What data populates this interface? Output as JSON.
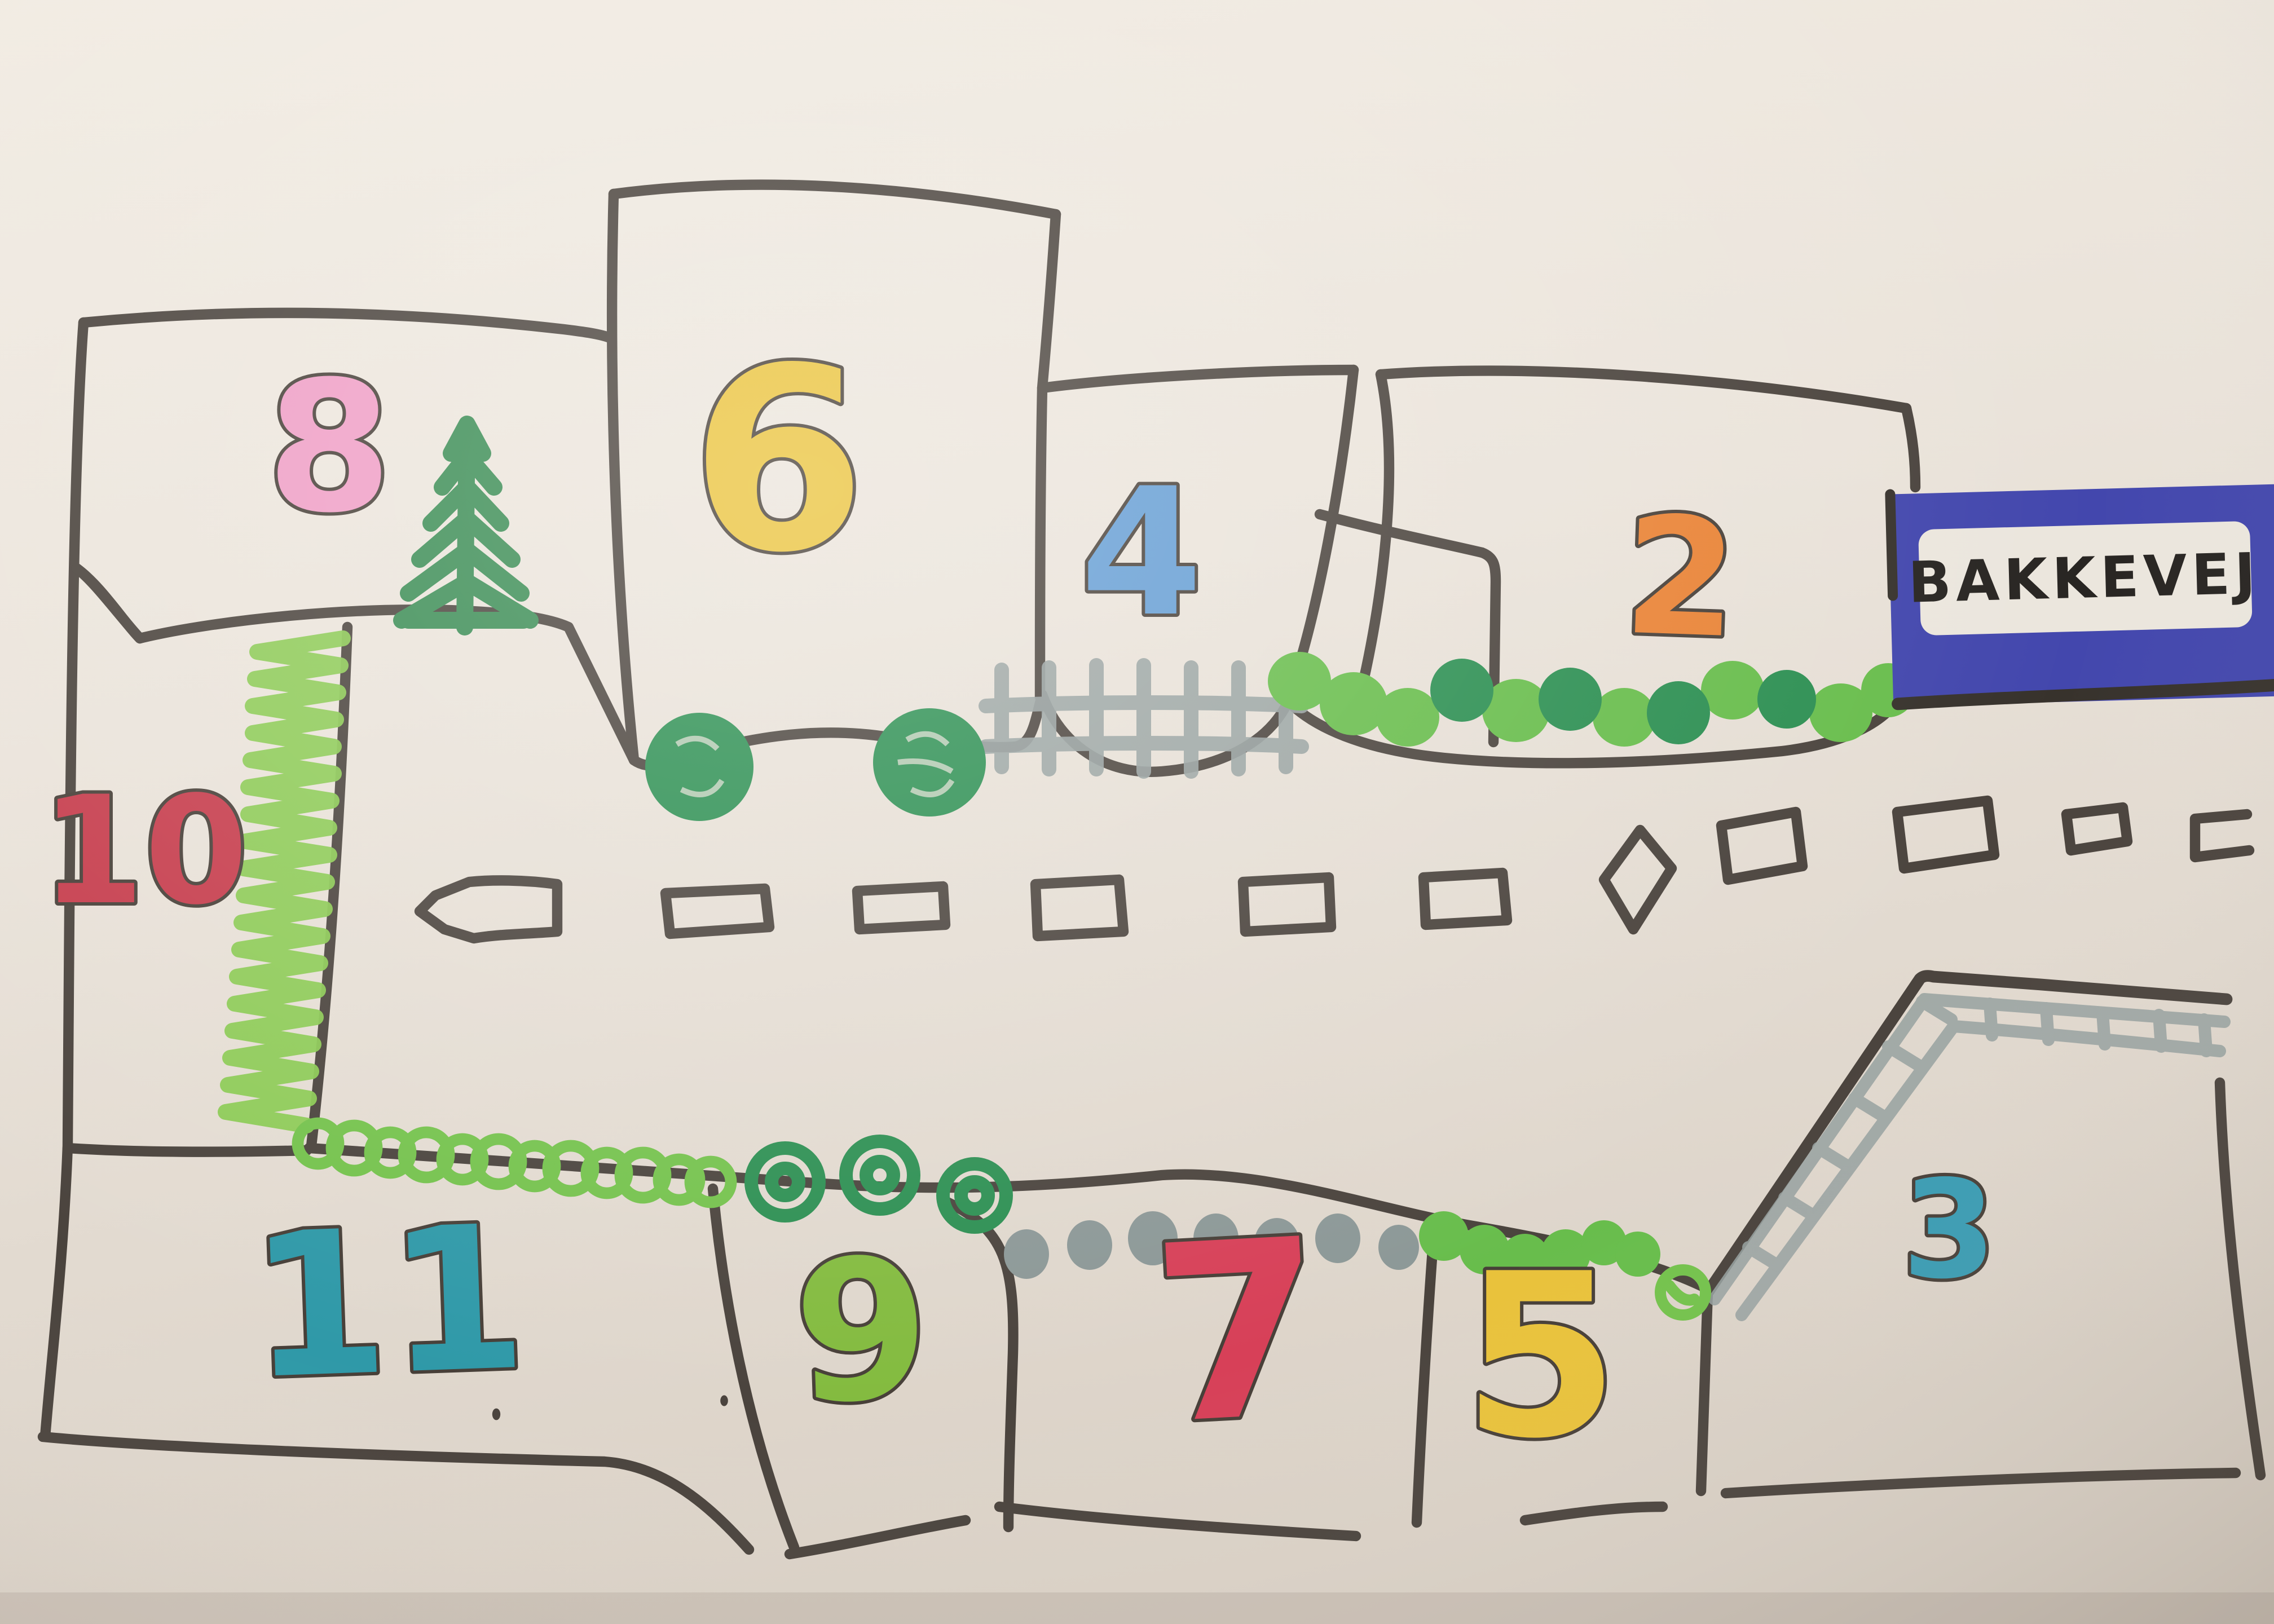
{
  "sign": {
    "label": "BAKKEVEJ",
    "background": "#4347ad",
    "panel": "#ebe6dd",
    "text_color": "#282522"
  },
  "plots": [
    {
      "number": "8",
      "color": "#ef9ec6"
    },
    {
      "number": "6",
      "color": "#eac33c"
    },
    {
      "number": "4",
      "color": "#649dd4"
    },
    {
      "number": "2",
      "color": "#e98336"
    },
    {
      "number": "10",
      "color": "#c63c4c"
    },
    {
      "number": "11",
      "color": "#2f99a8"
    },
    {
      "number": "9",
      "color": "#83bb3f"
    },
    {
      "number": "7",
      "color": "#d74058"
    },
    {
      "number": "5",
      "color": "#e9c23b"
    },
    {
      "number": "3",
      "color": "#3a9cb3"
    }
  ],
  "road": {
    "arrow_direction": "left",
    "center_dash_count": 10
  },
  "colors": {
    "paper": "#e8e1d8",
    "outline": "#4a433d",
    "tree_green": "#3a8c54",
    "bush_dark": "#2c8f52",
    "bush_light": "#68bd4c",
    "hedge_zigzag": "#8ac952",
    "hedge_loops": "#74c24c",
    "rail_grey": "#97a1a0",
    "dot_grey": "#8c9897"
  }
}
